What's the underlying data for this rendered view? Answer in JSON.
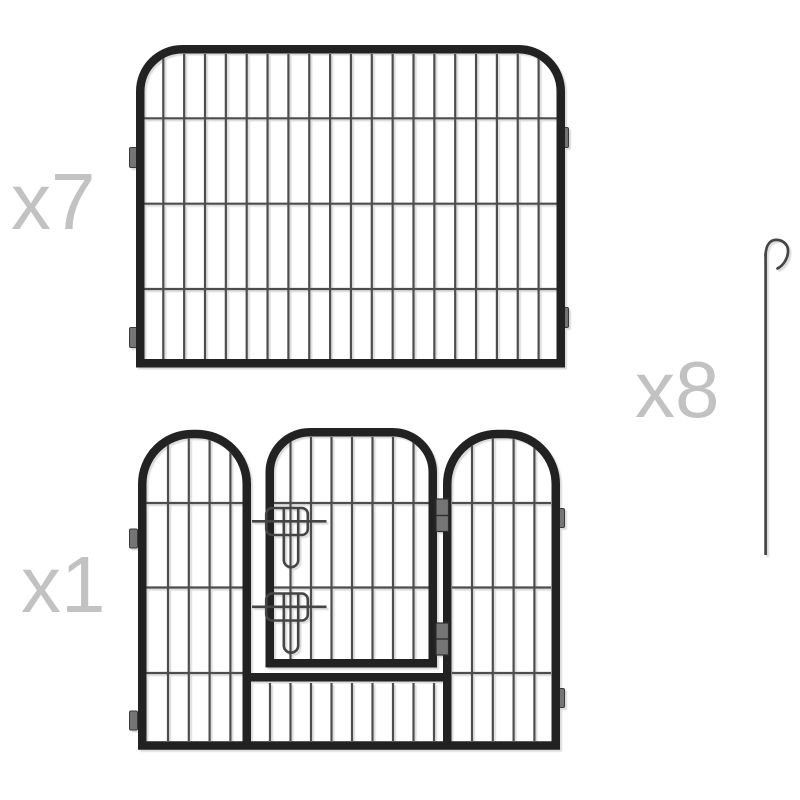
{
  "parts": {
    "panel": {
      "label": "x7",
      "count": 7,
      "part_name": "playpen-wire-panel"
    },
    "door_panel": {
      "label": "x1",
      "count": 1,
      "part_name": "playpen-door-panel"
    },
    "stake": {
      "label": "x8",
      "count": 8,
      "part_name": "ground-stake"
    }
  },
  "colors": {
    "background": "#ffffff",
    "frame": "#222222",
    "wire": "#4d4d4d",
    "hardware": "#757575",
    "latch": "#454545",
    "label": "#c2c2c2"
  }
}
